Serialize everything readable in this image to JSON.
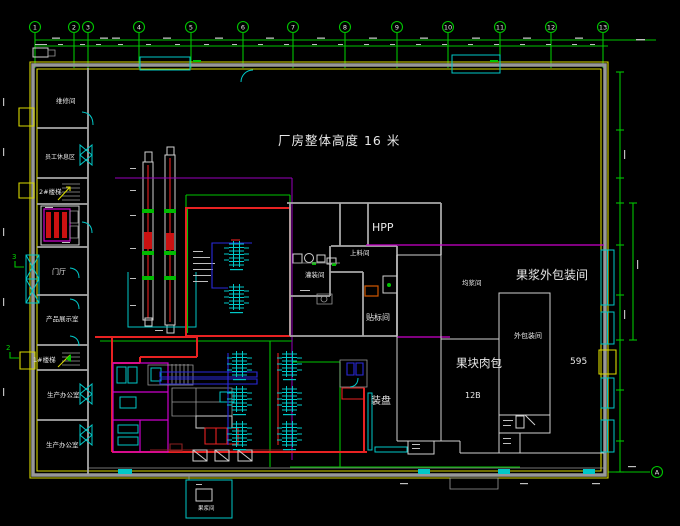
{
  "app": {
    "type": "cad-floor-plan-viewport"
  },
  "title": "厂房整体高度 16 米",
  "rooms": {
    "maintenance": "维修间",
    "staff_rest": "员工休息区",
    "stair2": "2#楼梯",
    "lobby": "门厅",
    "product_showroom": "产品展示室",
    "stair1": "1#楼梯",
    "production_office1": "生产办公室",
    "production_office2": "生产办公室",
    "hpp": "HPP",
    "feeding": "上料间",
    "filling": "灌装间",
    "labeling": "贴标间",
    "tray_loading": "装盘",
    "pulp_outer_packing": "果浆外包装间",
    "homogenizing": "均浆间",
    "outer_packing": "外包装间",
    "fruit_block_pack": "果块肉包",
    "pulp_room": "果浆间"
  },
  "annotations": {
    "dim_595": "595",
    "dim_12b": "12B"
  },
  "grid": {
    "columns": [
      "1",
      "2",
      "3",
      "4",
      "5",
      "6",
      "7",
      "8",
      "9",
      "10",
      "11",
      "12",
      "13"
    ],
    "row_letter": "A",
    "section_mark_upper": "3",
    "section_mark_lower": "2"
  },
  "colors": {
    "background": "#000000",
    "grid_green": "#00c400",
    "window_cyan": "#00c8c8",
    "wall_yellow": "#d9d900",
    "wall_grey": "#a8a8a8",
    "equipment_red": "#e82222",
    "partition_magenta": "#cc00cc",
    "pipe_blue": "#2a2add",
    "text_white": "#e8e8e8"
  }
}
